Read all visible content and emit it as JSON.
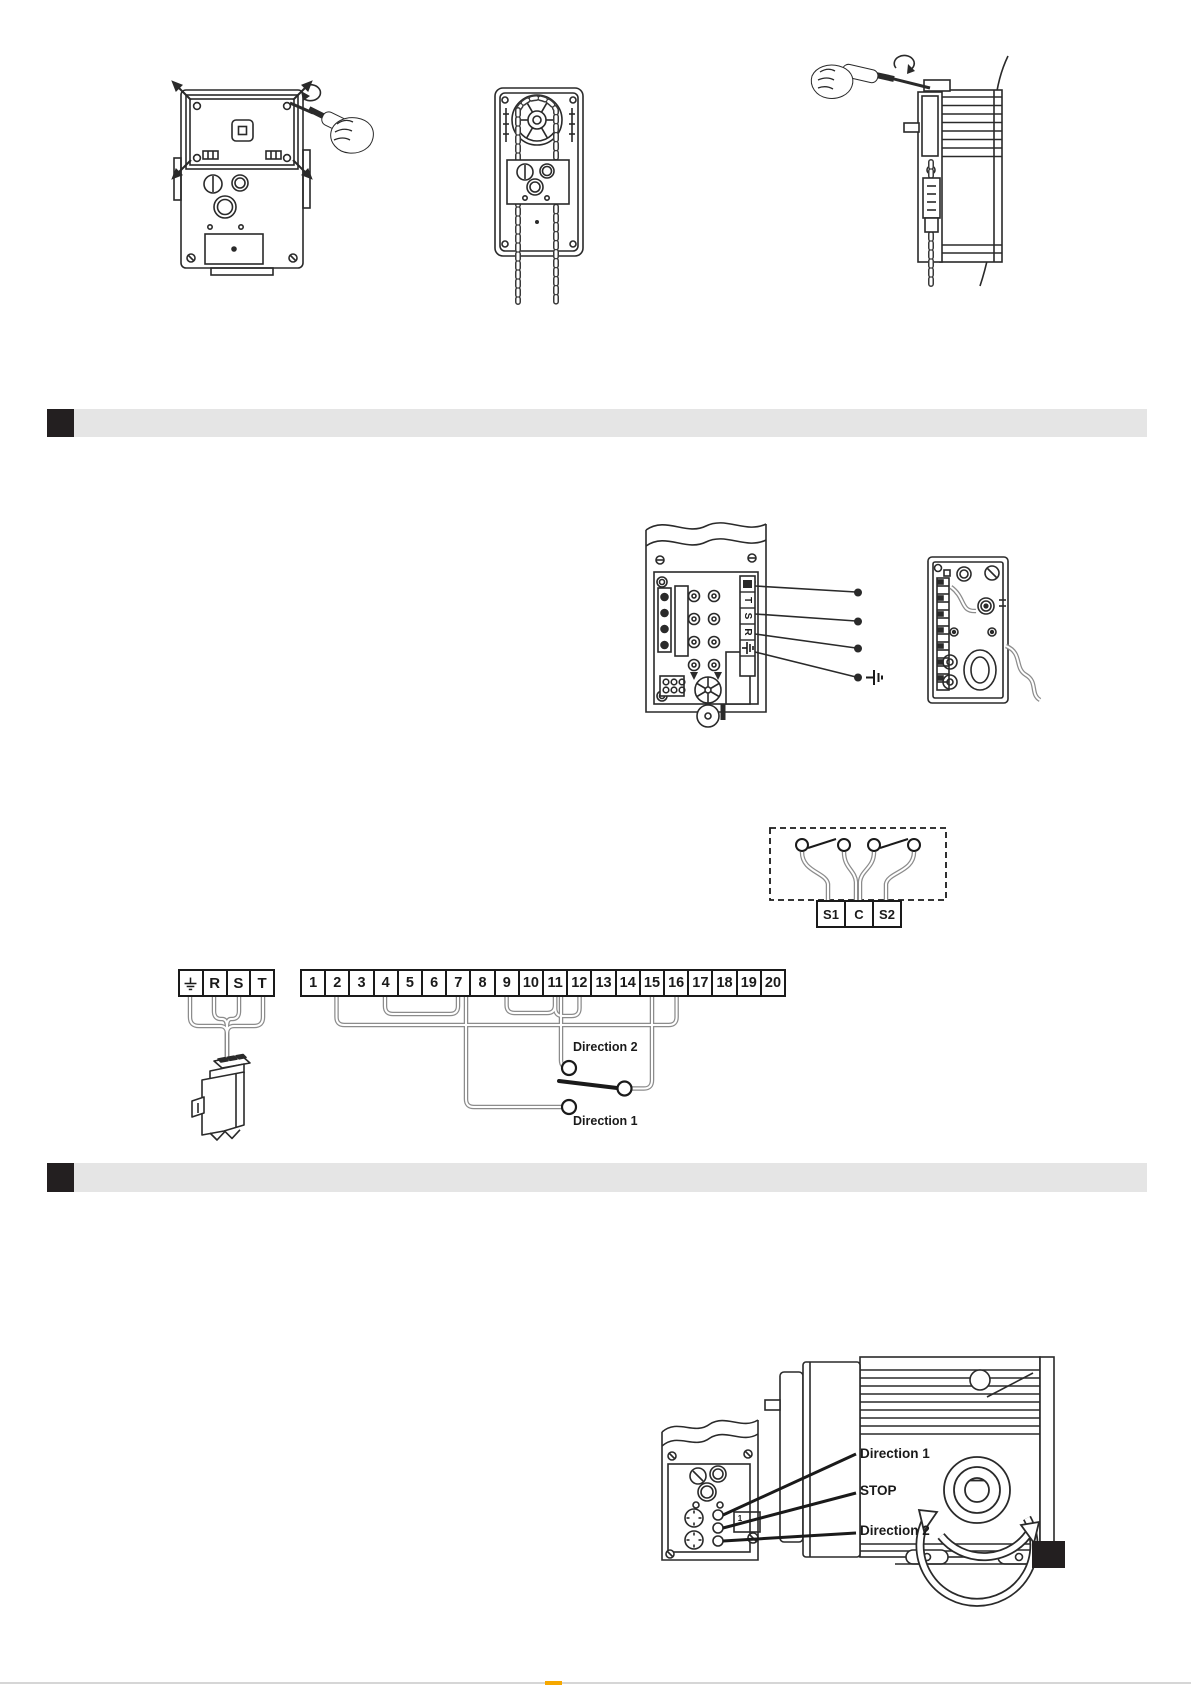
{
  "page": {
    "bg": "#ffffff",
    "ink": "#2a2a2a",
    "bar_gray": "#e5e5e5",
    "bar_black": "#231f20",
    "accent_orange": "#f6a800",
    "rule_gray": "#d6d6d6"
  },
  "power_terminals": {
    "ground_icon": "earth-ground-icon",
    "cells": [
      "R",
      "S",
      "T"
    ]
  },
  "numbered_terminals": {
    "cells": [
      "1",
      "2",
      "3",
      "4",
      "5",
      "6",
      "7",
      "8",
      "9",
      "10",
      "11",
      "12",
      "13",
      "14",
      "15",
      "16",
      "17",
      "18",
      "19",
      "20"
    ]
  },
  "switch_labels": {
    "direction2": "Direction 2",
    "direction1": "Direction 1"
  },
  "limit_switch_terminals": {
    "cells": [
      "S1",
      "C",
      "S2"
    ]
  },
  "control_box_strip": {
    "labels": [
      "T",
      "S",
      "R"
    ],
    "ground_icon": "earth-ground-icon"
  },
  "motor_controls": {
    "direction1": "Direction 1",
    "stop": "STOP",
    "direction2": "Direction 2",
    "panel_label": "1"
  }
}
